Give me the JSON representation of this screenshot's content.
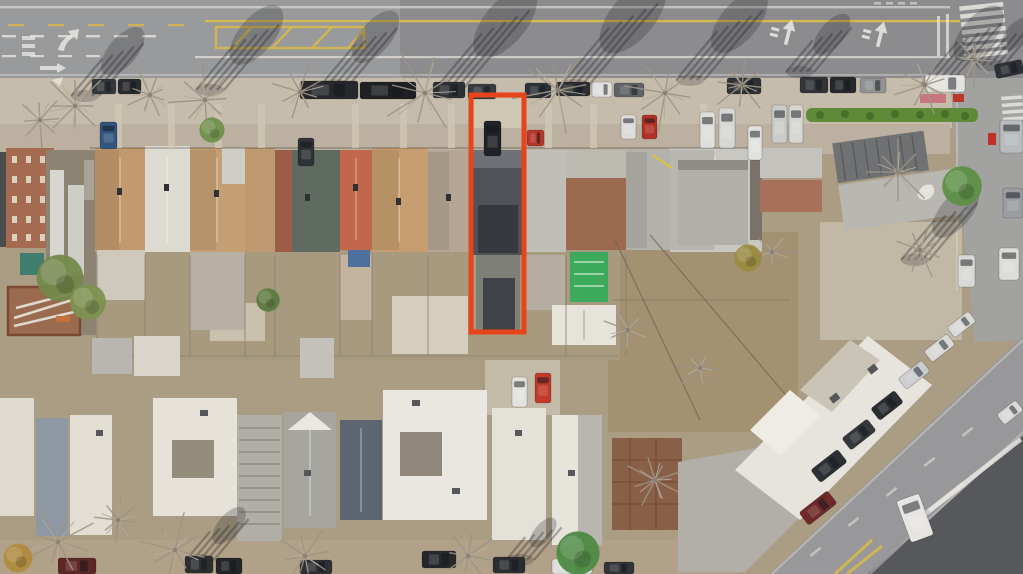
{
  "meta": {
    "image_type": "aerial-drone-photo",
    "description": "Overhead aerial photo of a dense residential block in winter: a wide avenue with lane arrows, yellow hatch zone and crosswalk at top; a row of attached houses with tan, gray, salmon and dark roofs; cluttered rear yards in the middle; flat white-roofed buildings along the bottom; a diagonal avenue with parked cars and a ladder crosswalk at bottom right. A narrow through-lot with a dark gray roof is outlined in orange-red in the center."
  },
  "annotation": {
    "label": "highlighted-property-lot",
    "color": "#e8441b",
    "x": 471,
    "y": 95,
    "width": 53,
    "height": 237,
    "stroke_width": 5
  },
  "palette": {
    "ground": "#ab9d83",
    "asphalt": "#8c8c8e",
    "asphalt_light": "#a2a2a0",
    "avenue": "#98989a",
    "asphalt_dark": "#56585b",
    "sidewalk": "#c6bcab",
    "apron": "#bcb1a0",
    "sidewalk_bottom": "#b2a189",
    "yard": "#a39172",
    "marking_white": "#ece9e3",
    "marking_yellow": "#d9b94c",
    "hedge": "#5f8a38"
  },
  "cars": [
    {
      "x": 92,
      "y": 79,
      "w": 24,
      "h": 15,
      "c": "#34373c"
    },
    {
      "x": 118,
      "y": 79,
      "w": 23,
      "h": 15,
      "c": "#282b2f"
    },
    {
      "x": 300,
      "y": 81,
      "w": 58,
      "h": 18,
      "c": "#26282c"
    },
    {
      "x": 360,
      "y": 82,
      "w": 56,
      "h": 17,
      "c": "#1e2023"
    },
    {
      "x": 433,
      "y": 82,
      "w": 32,
      "h": 16,
      "c": "#2c2f33"
    },
    {
      "x": 468,
      "y": 84,
      "w": 28,
      "h": 15,
      "c": "#383b40"
    },
    {
      "x": 525,
      "y": 83,
      "w": 26,
      "h": 15,
      "c": "#2d3138"
    },
    {
      "x": 556,
      "y": 82,
      "w": 34,
      "h": 14,
      "c": "#2b2e32"
    },
    {
      "x": 592,
      "y": 82,
      "w": 20,
      "h": 15,
      "c": "#dfe0de"
    },
    {
      "x": 614,
      "y": 83,
      "w": 30,
      "h": 14,
      "c": "#5f6266"
    },
    {
      "x": 727,
      "y": 78,
      "w": 34,
      "h": 16,
      "c": "#303236"
    },
    {
      "x": 800,
      "y": 77,
      "w": 28,
      "h": 16,
      "c": "#323438"
    },
    {
      "x": 830,
      "y": 77,
      "w": 26,
      "h": 16,
      "c": "#26282c"
    },
    {
      "x": 860,
      "y": 78,
      "w": 26,
      "h": 15,
      "c": "#909294"
    },
    {
      "x": 925,
      "y": 75,
      "w": 40,
      "h": 17,
      "c": "#e3e2df"
    },
    {
      "x": 995,
      "y": 62,
      "w": 28,
      "h": 14,
      "a": -12,
      "c": "#2d3034"
    },
    {
      "x": 700,
      "y": 112,
      "w": 15,
      "h": 36,
      "c": "#dedfdd"
    },
    {
      "x": 719,
      "y": 108,
      "w": 16,
      "h": 40,
      "c": "#d7d8d5"
    },
    {
      "x": 748,
      "y": 126,
      "w": 14,
      "h": 34,
      "c": "#e1e1de"
    },
    {
      "x": 772,
      "y": 105,
      "w": 15,
      "h": 38,
      "c": "#caccca"
    },
    {
      "x": 789,
      "y": 105,
      "w": 14,
      "h": 38,
      "c": "#d6d6d3"
    },
    {
      "x": 100,
      "y": 122,
      "w": 17,
      "h": 27,
      "c": "#31557e"
    },
    {
      "x": 298,
      "y": 138,
      "w": 16,
      "h": 28,
      "c": "#2e3135"
    },
    {
      "x": 484,
      "y": 121,
      "w": 17,
      "h": 35,
      "c": "#1f2226"
    },
    {
      "x": 527,
      "y": 130,
      "w": 17,
      "h": 16,
      "c": "#b5372b"
    },
    {
      "x": 621,
      "y": 115,
      "w": 15,
      "h": 24,
      "c": "#dcdcda"
    },
    {
      "x": 642,
      "y": 115,
      "w": 15,
      "h": 24,
      "c": "#b03227"
    },
    {
      "x": 512,
      "y": 377,
      "w": 15,
      "h": 30,
      "c": "#e2e2df"
    },
    {
      "x": 535,
      "y": 373,
      "w": 16,
      "h": 30,
      "c": "#bf3a2a"
    },
    {
      "x": 1000,
      "y": 120,
      "w": 23,
      "h": 33,
      "c": "#b9babb"
    },
    {
      "x": 1003,
      "y": 188,
      "w": 20,
      "h": 30,
      "c": "#9a9da1"
    },
    {
      "x": 999,
      "y": 248,
      "w": 20,
      "h": 32,
      "c": "#dcdcd9"
    },
    {
      "x": 958,
      "y": 255,
      "w": 17,
      "h": 32,
      "c": "#d8d8d5"
    },
    {
      "x": 812,
      "y": 458,
      "w": 34,
      "h": 16,
      "a": -38,
      "c": "#2c2f33"
    },
    {
      "x": 843,
      "y": 427,
      "w": 32,
      "h": 15,
      "a": -38,
      "c": "#34373b"
    },
    {
      "x": 872,
      "y": 398,
      "w": 30,
      "h": 15,
      "a": -38,
      "c": "#2a2d31"
    },
    {
      "x": 899,
      "y": 368,
      "w": 30,
      "h": 14,
      "a": -38,
      "c": "#caccce"
    },
    {
      "x": 925,
      "y": 341,
      "w": 29,
      "h": 14,
      "a": -38,
      "c": "#d9dad8"
    },
    {
      "x": 948,
      "y": 318,
      "w": 27,
      "h": 13,
      "a": -38,
      "c": "#dadbd9"
    },
    {
      "x": 800,
      "y": 500,
      "w": 36,
      "h": 16,
      "a": -38,
      "c": "#6e2a28"
    },
    {
      "x": 903,
      "y": 496,
      "w": 24,
      "h": 44,
      "a": -20,
      "c": "#e6e5e2"
    },
    {
      "x": 998,
      "y": 406,
      "w": 24,
      "h": 13,
      "a": -38,
      "c": "#d9dad7"
    },
    {
      "x": 58,
      "y": 558,
      "w": 38,
      "h": 16,
      "c": "#5e2726"
    },
    {
      "x": 185,
      "y": 556,
      "w": 28,
      "h": 17,
      "c": "#2c2e32"
    },
    {
      "x": 216,
      "y": 558,
      "w": 26,
      "h": 16,
      "c": "#232528"
    },
    {
      "x": 300,
      "y": 560,
      "w": 32,
      "h": 14,
      "c": "#2e3034"
    },
    {
      "x": 422,
      "y": 551,
      "w": 34,
      "h": 17,
      "c": "#26282c"
    },
    {
      "x": 493,
      "y": 557,
      "w": 32,
      "h": 16,
      "c": "#2b2d31"
    },
    {
      "x": 552,
      "y": 559,
      "w": 40,
      "h": 15,
      "c": "#dedfdc"
    },
    {
      "x": 604,
      "y": 562,
      "w": 30,
      "h": 12,
      "c": "#313438"
    }
  ],
  "trees": [
    {
      "t": "b",
      "x": 75,
      "y": 106,
      "r": 34
    },
    {
      "t": "b",
      "x": 150,
      "y": 95,
      "r": 26
    },
    {
      "t": "b",
      "x": 205,
      "y": 100,
      "r": 38
    },
    {
      "t": "b",
      "x": 300,
      "y": 92,
      "r": 30
    },
    {
      "t": "b",
      "x": 425,
      "y": 93,
      "r": 44
    },
    {
      "t": "b",
      "x": 558,
      "y": 90,
      "r": 46
    },
    {
      "t": "b",
      "x": 665,
      "y": 93,
      "r": 40
    },
    {
      "t": "b",
      "x": 742,
      "y": 85,
      "r": 30
    },
    {
      "t": "b",
      "x": 925,
      "y": 85,
      "r": 30
    },
    {
      "t": "b",
      "x": 975,
      "y": 60,
      "r": 26
    },
    {
      "t": "b",
      "x": 898,
      "y": 172,
      "r": 36
    },
    {
      "t": "b",
      "x": 920,
      "y": 250,
      "r": 28
    },
    {
      "t": "b",
      "x": 40,
      "y": 120,
      "r": 26
    },
    {
      "t": "b",
      "x": 58,
      "y": 542,
      "r": 40
    },
    {
      "t": "b",
      "x": 175,
      "y": 550,
      "r": 38
    },
    {
      "t": "b",
      "x": 305,
      "y": 556,
      "r": 30
    },
    {
      "t": "b",
      "x": 468,
      "y": 556,
      "r": 28
    },
    {
      "t": "b",
      "x": 118,
      "y": 520,
      "r": 24
    },
    {
      "t": "b",
      "x": 655,
      "y": 480,
      "r": 30
    },
    {
      "t": "b",
      "x": 700,
      "y": 368,
      "r": 26
    },
    {
      "t": "b",
      "x": 772,
      "y": 252,
      "r": 22
    },
    {
      "t": "b",
      "x": 628,
      "y": 330,
      "r": 24
    },
    {
      "t": "g",
      "x": 962,
      "y": 186,
      "r": 22,
      "c": "#5d8f46"
    },
    {
      "t": "g",
      "x": 578,
      "y": 553,
      "r": 24,
      "c": "#4d8a43"
    },
    {
      "t": "g",
      "x": 212,
      "y": 130,
      "r": 14,
      "c": "#6f8f4b"
    },
    {
      "t": "g",
      "x": 60,
      "y": 278,
      "r": 26,
      "c": "#74884b"
    },
    {
      "t": "g",
      "x": 88,
      "y": 302,
      "r": 20,
      "c": "#7d9150"
    },
    {
      "t": "g",
      "x": 268,
      "y": 300,
      "r": 13,
      "c": "#5d7a40"
    },
    {
      "t": "g",
      "x": 18,
      "y": 558,
      "r": 16,
      "c": "#b08a3e"
    },
    {
      "t": "g",
      "x": 748,
      "y": 258,
      "r": 15,
      "c": "#9a8a3f"
    }
  ],
  "shadows": [
    {
      "x": 85,
      "y": 96,
      "len": 65
    },
    {
      "x": 210,
      "y": 90,
      "len": 80
    },
    {
      "x": 335,
      "y": 85,
      "len": 70
    },
    {
      "x": 450,
      "y": 88,
      "len": 95
    },
    {
      "x": 575,
      "y": 85,
      "len": 100
    },
    {
      "x": 690,
      "y": 80,
      "len": 85
    },
    {
      "x": 800,
      "y": 72,
      "len": 55
    },
    {
      "x": 935,
      "y": 85,
      "len": 75
    },
    {
      "x": 990,
      "y": 65,
      "len": 45
    },
    {
      "x": 915,
      "y": 260,
      "len": 70
    },
    {
      "x": 200,
      "y": 560,
      "len": 50
    },
    {
      "x": 520,
      "y": 560,
      "len": 40
    }
  ]
}
